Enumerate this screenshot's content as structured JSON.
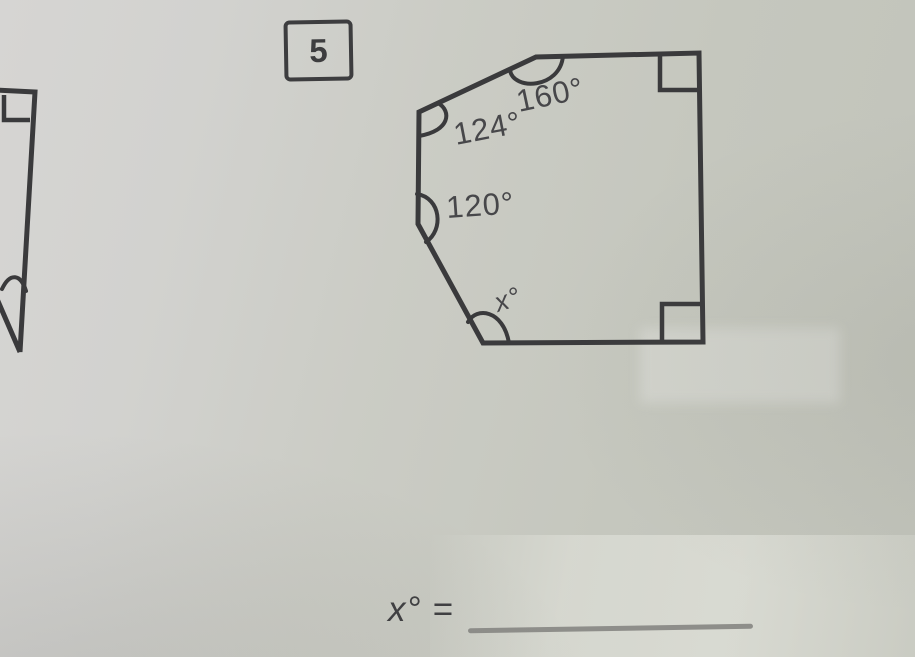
{
  "colors": {
    "ink": "#3a3a3c",
    "label_text": "#47474a",
    "paper_light": "#d6d5d3",
    "paper_dark": "#c0c2b9",
    "answer_line": "#8e8e8a"
  },
  "problem": {
    "number": "5",
    "answer_prompt": "x° =",
    "figure": {
      "angle_top": "160°",
      "angle_upper_left": "124°",
      "angle_left": "120°",
      "angle_bottom": "x°"
    }
  },
  "partial_figure": {
    "angle_label": "x°"
  }
}
